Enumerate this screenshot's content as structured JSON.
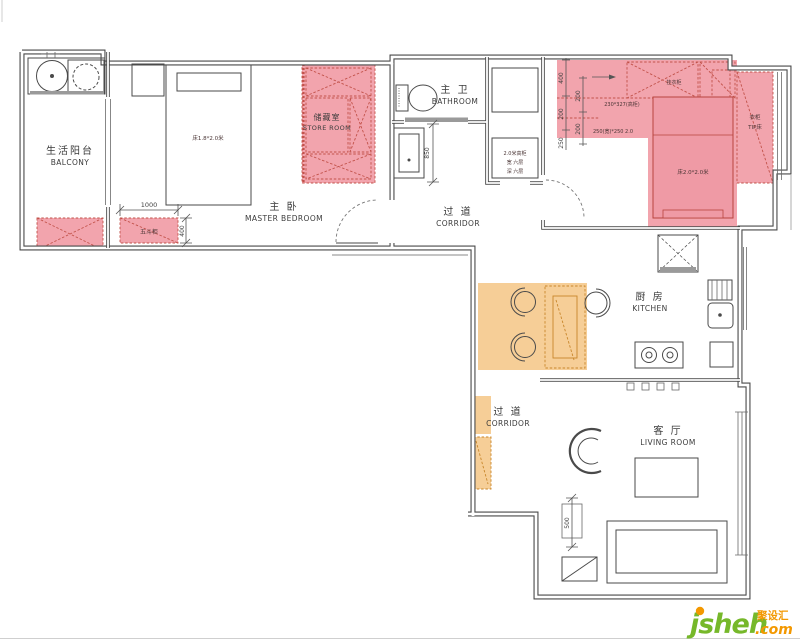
{
  "rooms": [
    {
      "id": "balcony",
      "zh": "生活阳台",
      "en": "BALCONY"
    },
    {
      "id": "master-bedroom",
      "zh": "主 卧",
      "en": "MASTER BEDROOM"
    },
    {
      "id": "store-room",
      "zh": "储藏室",
      "en": "STORE ROOM"
    },
    {
      "id": "bathroom",
      "zh": "主 卫",
      "en": "BATHROOM"
    },
    {
      "id": "corridor-upper",
      "zh": "过 道",
      "en": "CORRIDOR"
    },
    {
      "id": "kitchen",
      "zh": "厨 房",
      "en": "KITCHEN"
    },
    {
      "id": "corridor-lower",
      "zh": "过 道",
      "en": "CORRIDOR"
    },
    {
      "id": "living-room",
      "zh": "客 厅",
      "en": "LIVING ROOM"
    }
  ],
  "annotations": {
    "master_bed": "床1.8*2.0米",
    "drawer_cabinet": "五斗柜",
    "second_bed": "床2.0*2.0米",
    "wardrobe_line1": "衣柜",
    "wardrobe_line2": "TIP床",
    "cabinet_line1": "2.0米高柜",
    "cabinet_line2": "宽 六层",
    "cabinet_line3": "深 六层",
    "closet_note1": "230*327(高柜)",
    "closet_note2": "250(宽)*250 2.0",
    "hanging": "挂衣柜"
  },
  "dimensions": {
    "balcony_width": "1000",
    "cabinet_depth": "400",
    "wash_width": "850",
    "sofa_side": "500",
    "w400": "400",
    "w200a": "200",
    "w200b": "200",
    "w200c": "200",
    "w250": "250"
  },
  "logo": {
    "brand": "jsheh",
    "tld": ".com",
    "cn": "聚设汇"
  },
  "colors": {
    "pink_fill": "#F2A4AD",
    "pink_line": "#C2524A",
    "orange_fill": "#F6CE97",
    "orange_line": "#C8862B",
    "wall": "#4A4A4A",
    "logo_green": "#76B82A",
    "logo_orange": "#F39800"
  }
}
